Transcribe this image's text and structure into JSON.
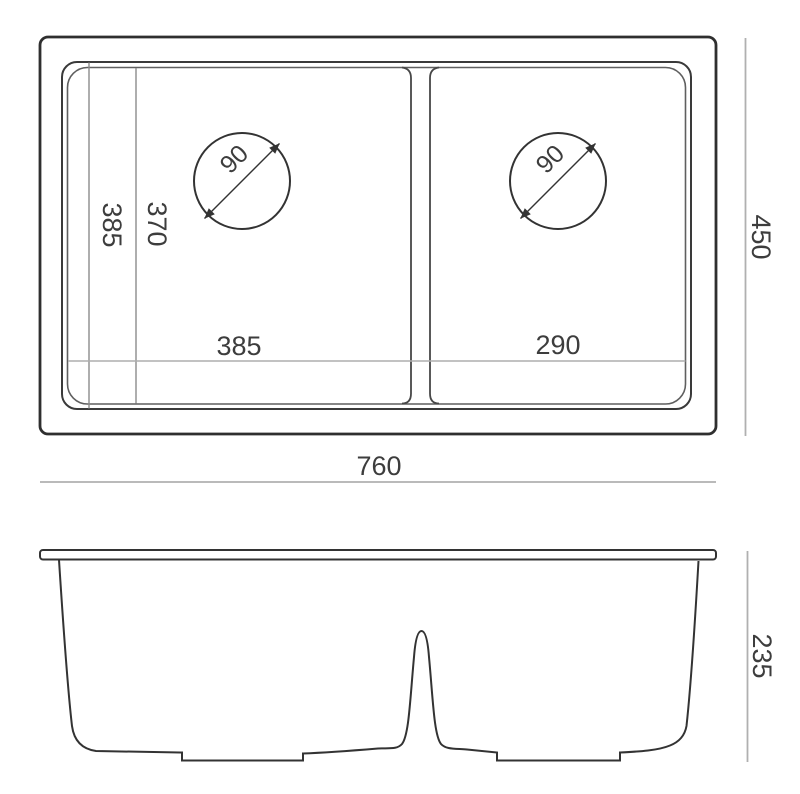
{
  "drawing": {
    "type": "double-bowl-sink-technical-drawing",
    "views": [
      "top-view",
      "front-section-view"
    ],
    "colors": {
      "background": "#ffffff",
      "outline": "#2f2f2f",
      "secondary_outline": "#5f5f5f",
      "dimension_line_light": "#b0b0b0",
      "dimension_line_dark": "#8c8c8c",
      "text": "#3d3d3d"
    },
    "top_view": {
      "labels": {
        "overall_width": "760",
        "overall_depth": "450",
        "left_bowl_width": "385",
        "right_bowl_width": "290",
        "bowl_depth_outer": "385",
        "bowl_depth_inner": "370",
        "left_drain_diameter": "90",
        "right_drain_diameter": "90"
      }
    },
    "front_view": {
      "labels": {
        "bowl_height": "235"
      }
    }
  }
}
